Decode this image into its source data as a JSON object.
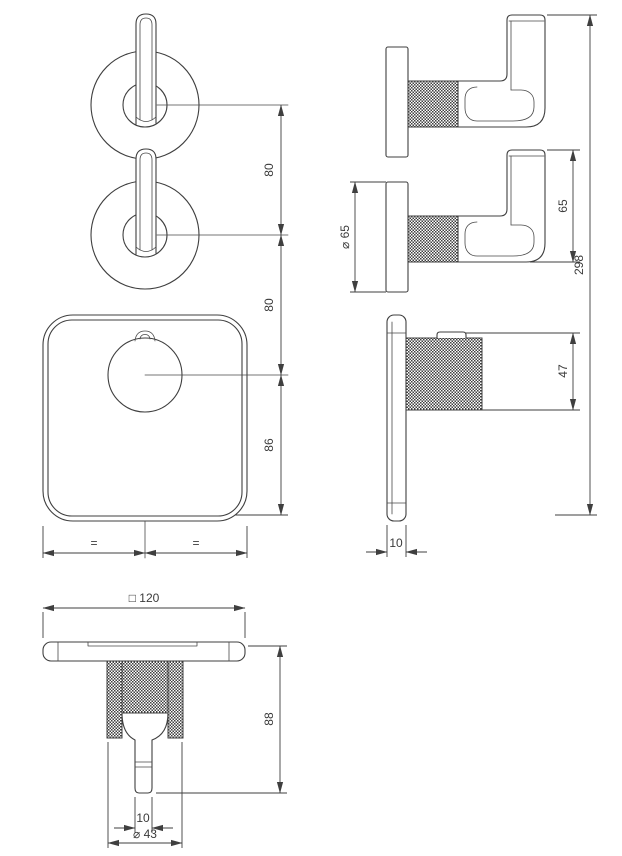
{
  "drawing": {
    "kind": "thermostatic-shower-mixer-technical-drawing",
    "background": "#ffffff",
    "line_color": "#3f3f3f",
    "dims": {
      "handle_spacing": "80",
      "handle_to_knob": "80",
      "knob_to_plate_edge": "86",
      "equal_left": "=",
      "equal_right": "=",
      "flange_diameter": "⌀ 65",
      "lever_height": "65",
      "overall_height": "298",
      "knob_depth": "47",
      "plate_thickness": "10",
      "plate_width": "□ 120",
      "overall_depth": "88",
      "stem_diameter": "10",
      "knob_diameter": "⌀ 43"
    }
  }
}
